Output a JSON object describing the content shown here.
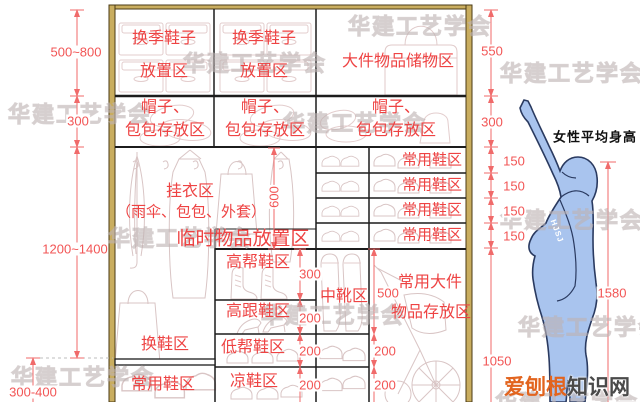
{
  "watermark": "华建工艺学会",
  "brand": {
    "part1": "爱刨根",
    "part2": "知识网"
  },
  "figure": {
    "label": "女性平均身高",
    "arm_tag": "HJSJ"
  },
  "zones": {
    "seasonal_shoes_1": "换季鞋子",
    "seasonal_shoes_2": "放置区",
    "bulky_storage": "大件物品储物区",
    "hats_1": "帽子、",
    "hats_2": "包包存放区",
    "hanging_1": "挂衣区",
    "hanging_2": "（雨伞、包包、外套）",
    "temp_items": "临时物品放置区",
    "daily_shoes": "常用鞋区",
    "high_top_shoes": "高帮鞋区",
    "high_heels": "高跟鞋区",
    "low_top_shoes": "低帮鞋区",
    "shoe_changing": "换鞋区",
    "sandals": "凉鞋区",
    "mid_boots": "中靴区",
    "bulky_daily_1": "常用大件",
    "bulky_daily_2": "物品存放区"
  },
  "dimensions": {
    "top_left": "500~800",
    "hat_row": "300",
    "mid_left": "1200~1400",
    "bottom_left": "300-400",
    "top_right": "550",
    "shelf_row": "150",
    "hanging_height": "600",
    "high_top": "300",
    "small_row": "200",
    "mid_boot": "500",
    "floor_clearance": "1050",
    "body_height": "1580"
  },
  "colors": {
    "dimension_red": "#f25555",
    "label_red": "#ee4343",
    "frame_tan": "#c9ad5f",
    "figure_blue": "#a9c4ee",
    "brand_orange": "#e2641e"
  }
}
